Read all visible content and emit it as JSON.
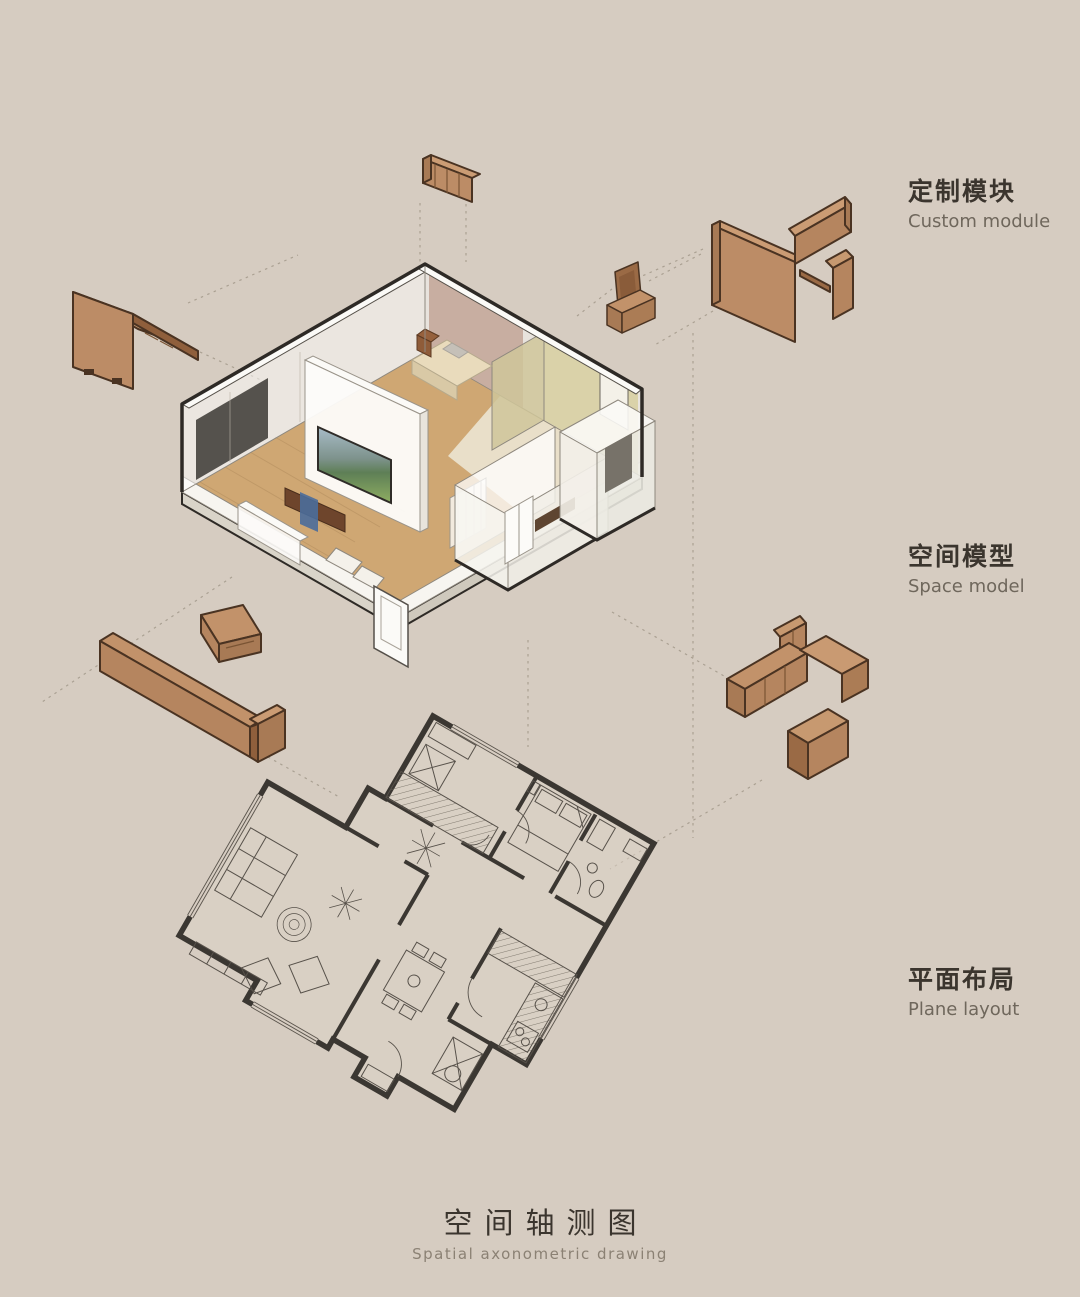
{
  "canvas": {
    "width": 1080,
    "height": 1297,
    "background": "#d6ccc1"
  },
  "labels": {
    "custom_module": {
      "zh": "定制模块",
      "en": "Custom module"
    },
    "space_model": {
      "zh": "空间模型",
      "en": "Space model"
    },
    "plane_layout": {
      "zh": "平面布局",
      "en": "Plane layout"
    }
  },
  "title": {
    "zh": "空间轴测图",
    "en": "Spatial axonometric drawing"
  },
  "palette": {
    "background": "#d6ccc1",
    "module_face": "#bc8c66",
    "module_top": "#cb9c74",
    "module_side": "#a87a55",
    "module_shadow": "#8f5f3c",
    "module_outline": "#4a3322",
    "model_outline": "#2e2a26",
    "wall_white": "#fbfaf7",
    "wall_line": "#8e887e",
    "floor_wood": "#cfa773",
    "floor_light": "#ebe5d3",
    "wall_mauve": "#c4a99b",
    "wall_yellow": "#d8d0a4",
    "screen_dark": "#55524d",
    "tv_sky": "#a8bcc8",
    "tv_green": "#6f9355",
    "table_wood": "#6e452c",
    "runner_blue": "#4a6d9b",
    "plan_wall": "#3b3732",
    "plan_line": "#57514a",
    "dash_line": "#a89e90",
    "text_dark": "#3b352e",
    "text_muted": "#6f675c"
  }
}
